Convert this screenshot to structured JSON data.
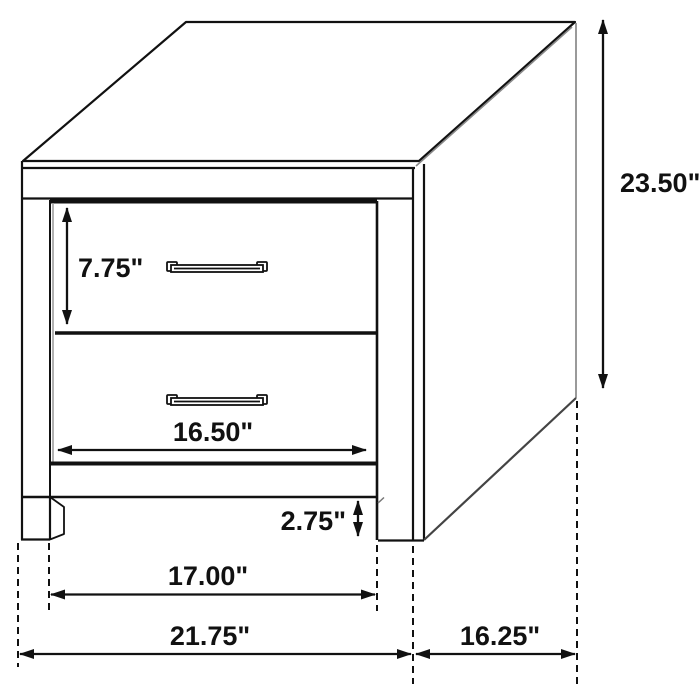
{
  "diagram": {
    "title": "2-drawer nightstand dimension diagram",
    "view": "three-quarter line drawing",
    "colors": {
      "line": "#111111",
      "soft_line": "#888888",
      "background": "#ffffff"
    },
    "dimensions": {
      "overall_height": "23.50\"",
      "drawer_front_height": "7.75\"",
      "drawer_front_width": "16.50\"",
      "base_clearance": "2.75\"",
      "leg_inner_span": "17.00\"",
      "overall_width": "21.75\"",
      "overall_depth": "16.25\""
    }
  }
}
